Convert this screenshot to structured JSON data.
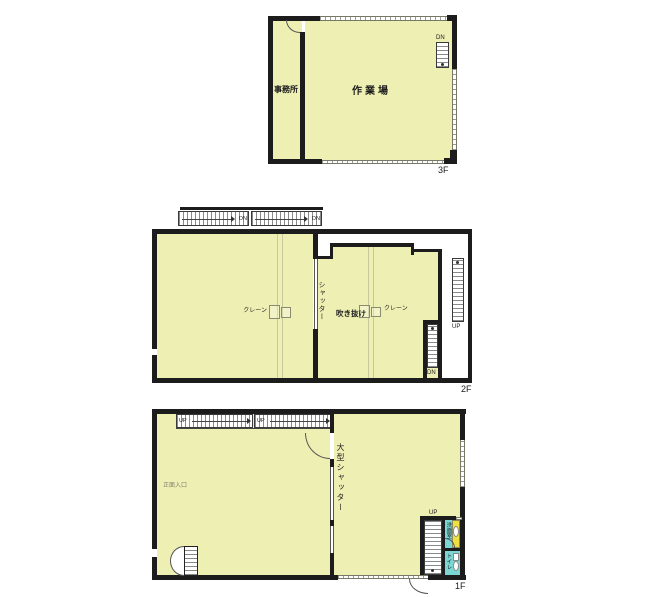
{
  "colors": {
    "floor_fill": "#edefb3",
    "wall": "#1c1c1c",
    "wet_floor": "#7cd7d4",
    "vanity": "#efe042"
  },
  "floor3": {
    "label": "3F",
    "office_label": "事務所",
    "workshop_label": "作業場",
    "stair_dn": "DN"
  },
  "floor2": {
    "label": "2F",
    "stair_dn_a": "DN",
    "stair_dn_b": "DN",
    "crane_left": "クレーン",
    "crane_right": "クレーン",
    "shutter_label": "シャッター",
    "atrium_label": "吹き抜け",
    "stair_up_ext": "UP",
    "stair_dn_inner": "DN"
  },
  "floor1": {
    "label": "1F",
    "stair_up_a": "UP",
    "stair_up_b": "UP",
    "entrance_label": "正面入口",
    "shutter_label": "大型シャッター",
    "stair_up_right": "UP",
    "washroom_label": "洗面室",
    "toilet_label": "トイレ"
  }
}
